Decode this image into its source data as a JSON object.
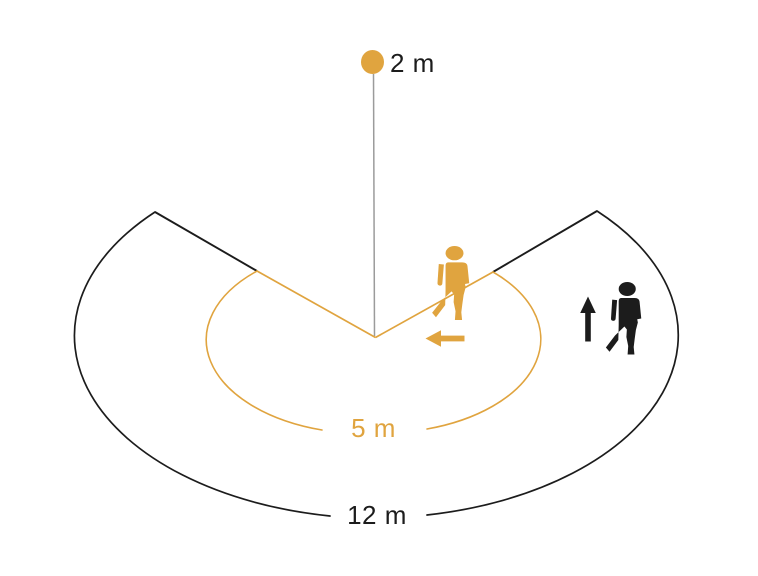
{
  "labels": {
    "mounting_height": "2 m",
    "inner_radius": "5 m",
    "outer_radius": "12 m"
  },
  "colors": {
    "accent_orange": "#E0A43F",
    "line_black": "#1C1C1C",
    "pole_gray": "#9B9B9B",
    "background": "#FFFFFF"
  },
  "icons": {
    "sensor_dot": "sensor-dot",
    "crossing_person": "walking-person-icon",
    "crossing_direction": "arrow-left-icon",
    "approaching_person": "walking-person-icon",
    "approaching_direction": "arrow-up-icon"
  }
}
